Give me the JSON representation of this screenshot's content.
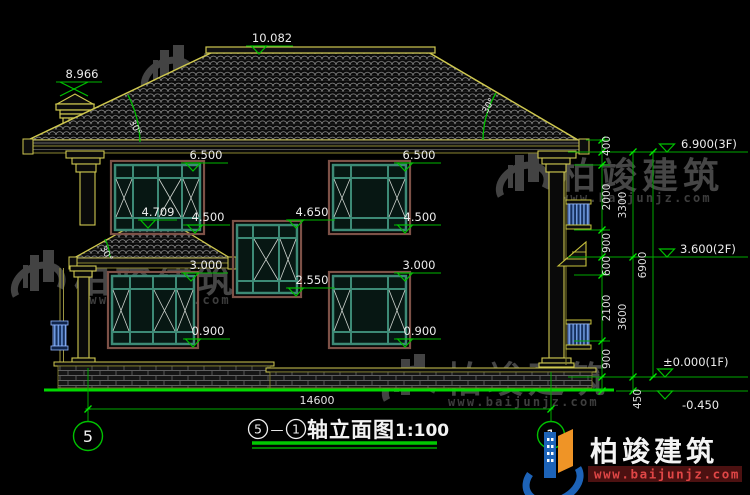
{
  "title_block": {
    "axis_from": "5",
    "separator": "—",
    "axis_to": "1",
    "name": "轴立面图",
    "scale": "1:100"
  },
  "axis_bubbles": {
    "left": "5",
    "right": "1"
  },
  "levels": {
    "ridge": "10.082",
    "chimney_top": "8.966",
    "win2_top": "6.500",
    "win2_sill": "4.500",
    "porch_ridge": "4.709",
    "stair_win_top": "4.650",
    "stair_win_sill": "2.550",
    "win1_top": "3.000",
    "win1_sill": "0.900",
    "floor3": "6.900(3F)",
    "floor2": "3.600(2F)",
    "floor1": "±0.000(1F)",
    "ground": "-0.450"
  },
  "dims": {
    "overall_width": "14600",
    "seg_400": "400",
    "seg_2000": "2000",
    "seg_900_upper": "900",
    "seg_600": "600",
    "seg_2100": "2100",
    "seg_900_lower": "900",
    "seg_450": "450",
    "floor3_height": "3300",
    "floor2_height": "3600",
    "total_height": "6900"
  },
  "angles": {
    "roof_left": "30°",
    "roof_right": "30°",
    "porch_roof": "30°"
  },
  "watermark": {
    "brand": "柏竣建筑",
    "url": "www.baijunjz.com"
  },
  "logo": {
    "brand": "柏竣建筑",
    "url": "www.baijunjz.com"
  },
  "colors": {
    "line_yellow": "#cfc84f",
    "dim_green": "#00c000",
    "ground_green": "#00d800",
    "window_teal": "#3d8a76",
    "trim_brown": "#7d5147",
    "accent_blue": "#2a5fc0",
    "logo_blue": "#1d63b8",
    "logo_orange": "#ef9426",
    "watermark_gray": "#4a4a4a"
  }
}
